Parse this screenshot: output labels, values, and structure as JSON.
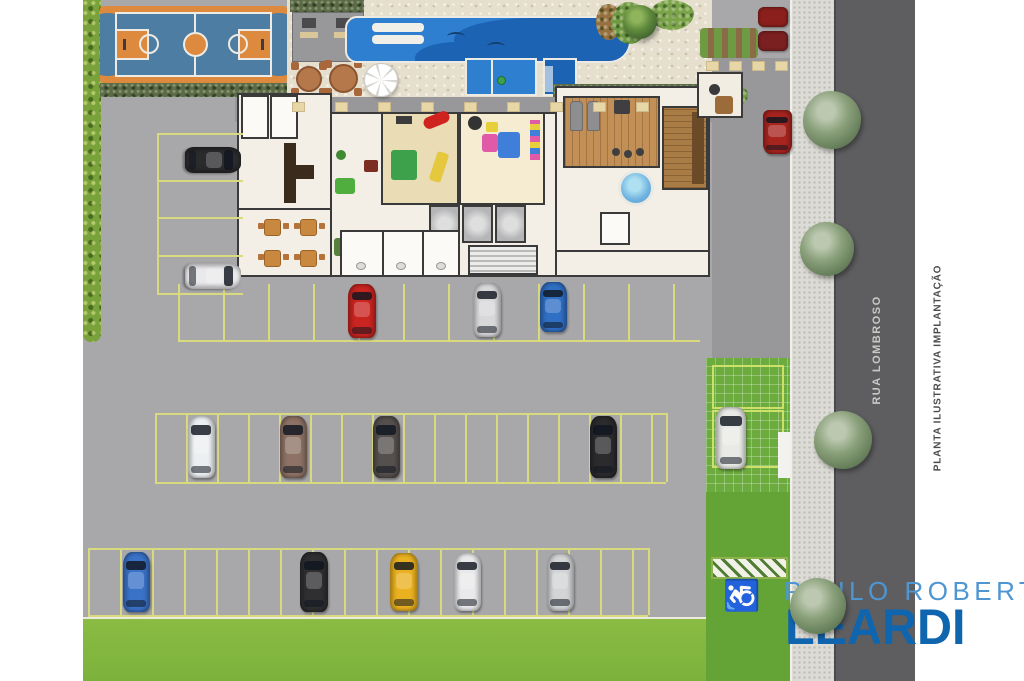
{
  "texts": {
    "street_name": "RUA LOMBROSO",
    "caption": "PLANTA ILUSTRATIVA IMPLANTAÇÃO",
    "brand_line1": "PAULO ROBERTO",
    "brand_line2": "LEARDI",
    "handicap_symbol": "♿"
  },
  "colors": {
    "asphalt": "#a8a8aa",
    "driveway": "#98989b",
    "street": "#5e5e60",
    "sidewalk": "#dcdbd5",
    "grass": "#7cb23c",
    "lawn": "#64a437",
    "paver_grass": "#6cab3e",
    "hedge": "#79a23a",
    "pool_water": "#2e7fd0",
    "pool_deep": "#1d63b4",
    "deck_stone": "#e6dfce",
    "court_orange": "#dd8a3f",
    "court_blue": "#4e7da3",
    "building_floor": "#f3efe6",
    "wall": "#3a3a3a",
    "parking_line": "#d9d97e",
    "brand_light_blue": "#4e96d2",
    "brand_dark_blue": "#1065af"
  },
  "cars": [
    {
      "name": "black-car",
      "color": "#2b2b2d",
      "x": 213,
      "y": 160,
      "w": 26,
      "h": 56,
      "rot": 90
    },
    {
      "name": "white-car",
      "color": "#e9e9eb",
      "x": 213,
      "y": 276,
      "w": 26,
      "h": 56,
      "rot": 90
    },
    {
      "name": "red-car",
      "color": "#c92420",
      "x": 362,
      "y": 311,
      "w": 28,
      "h": 54,
      "rot": 0
    },
    {
      "name": "silver-car",
      "color": "#d8d8da",
      "x": 487,
      "y": 310,
      "w": 28,
      "h": 54,
      "rot": 0
    },
    {
      "name": "blue-car",
      "color": "#2f6fc4",
      "x": 553,
      "y": 307,
      "w": 27,
      "h": 50,
      "rot": 0
    },
    {
      "name": "white-car",
      "color": "#eceff1",
      "x": 201,
      "y": 447,
      "w": 27,
      "h": 62,
      "rot": 0
    },
    {
      "name": "brown-car",
      "color": "#8d7265",
      "x": 293,
      "y": 447,
      "w": 27,
      "h": 62,
      "rot": 0
    },
    {
      "name": "gray-car",
      "color": "#55504e",
      "x": 386,
      "y": 447,
      "w": 27,
      "h": 62,
      "rot": 0
    },
    {
      "name": "black-car",
      "color": "#2b2b2d",
      "x": 603,
      "y": 447,
      "w": 27,
      "h": 62,
      "rot": 0
    },
    {
      "name": "white-car",
      "color": "#e9e9e6",
      "x": 731,
      "y": 438,
      "w": 30,
      "h": 62,
      "rot": 0
    },
    {
      "name": "blue-car",
      "color": "#3a72c8",
      "x": 136,
      "y": 582,
      "w": 27,
      "h": 60,
      "rot": 0
    },
    {
      "name": "black-car",
      "color": "#2f2f31",
      "x": 314,
      "y": 582,
      "w": 28,
      "h": 60,
      "rot": 0
    },
    {
      "name": "yellow-car",
      "color": "#e9b01f",
      "x": 404,
      "y": 582,
      "w": 28,
      "h": 58,
      "rot": 0
    },
    {
      "name": "white-car",
      "color": "#e9e9eb",
      "x": 467,
      "y": 582,
      "w": 27,
      "h": 58,
      "rot": 0
    },
    {
      "name": "silver-car",
      "color": "#d2d4d6",
      "x": 560,
      "y": 582,
      "w": 27,
      "h": 58,
      "rot": 0
    },
    {
      "name": "red-van",
      "color": "#a8241f",
      "x": 777,
      "y": 132,
      "w": 29,
      "h": 44,
      "rot": 0,
      "van": true
    }
  ],
  "trees": [
    {
      "x": 832,
      "y": 120,
      "r": 29,
      "dark": false
    },
    {
      "x": 827,
      "y": 249,
      "r": 27,
      "dark": false
    },
    {
      "x": 843,
      "y": 440,
      "r": 29,
      "dark": false
    },
    {
      "x": 818,
      "y": 606,
      "r": 28,
      "dark": false
    },
    {
      "x": 640,
      "y": 22,
      "r": 17,
      "dark": true
    }
  ],
  "parking_rows": [
    {
      "type": "hlines",
      "x0": 157,
      "x1": 243,
      "ys": [
        133,
        180,
        217,
        255,
        293
      ]
    },
    {
      "type": "vlines",
      "y0": 133,
      "y1": 293,
      "xs": [
        157
      ]
    },
    {
      "type": "vlines",
      "y0": 284,
      "y1": 340,
      "xs": [
        178,
        223,
        268,
        313,
        358,
        403,
        448,
        493,
        538,
        583,
        628,
        673
      ]
    },
    {
      "type": "hlines",
      "x0": 178,
      "x1": 700,
      "ys": [
        340
      ]
    },
    {
      "type": "vlines",
      "y0": 413,
      "y1": 482,
      "xs": [
        155,
        186,
        217,
        248,
        279,
        310,
        341,
        372,
        403,
        434,
        465,
        496,
        527,
        558,
        589,
        620,
        651,
        666
      ]
    },
    {
      "type": "hlines",
      "x0": 155,
      "x1": 666,
      "ys": [
        413,
        482
      ]
    },
    {
      "type": "vlines",
      "y0": 548,
      "y1": 615,
      "xs": [
        88,
        120,
        152,
        184,
        216,
        248,
        280,
        312,
        344,
        376,
        408,
        440,
        472,
        504,
        536,
        568,
        600,
        632,
        648
      ]
    },
    {
      "type": "hlines",
      "x0": 88,
      "x1": 648,
      "ys": [
        548,
        615
      ]
    }
  ],
  "markers": [
    {
      "y": 102,
      "xs": [
        292,
        335,
        378,
        421,
        464,
        507,
        550,
        593,
        636
      ]
    },
    {
      "y": 61,
      "xs": [
        706,
        729,
        752,
        775
      ]
    }
  ]
}
